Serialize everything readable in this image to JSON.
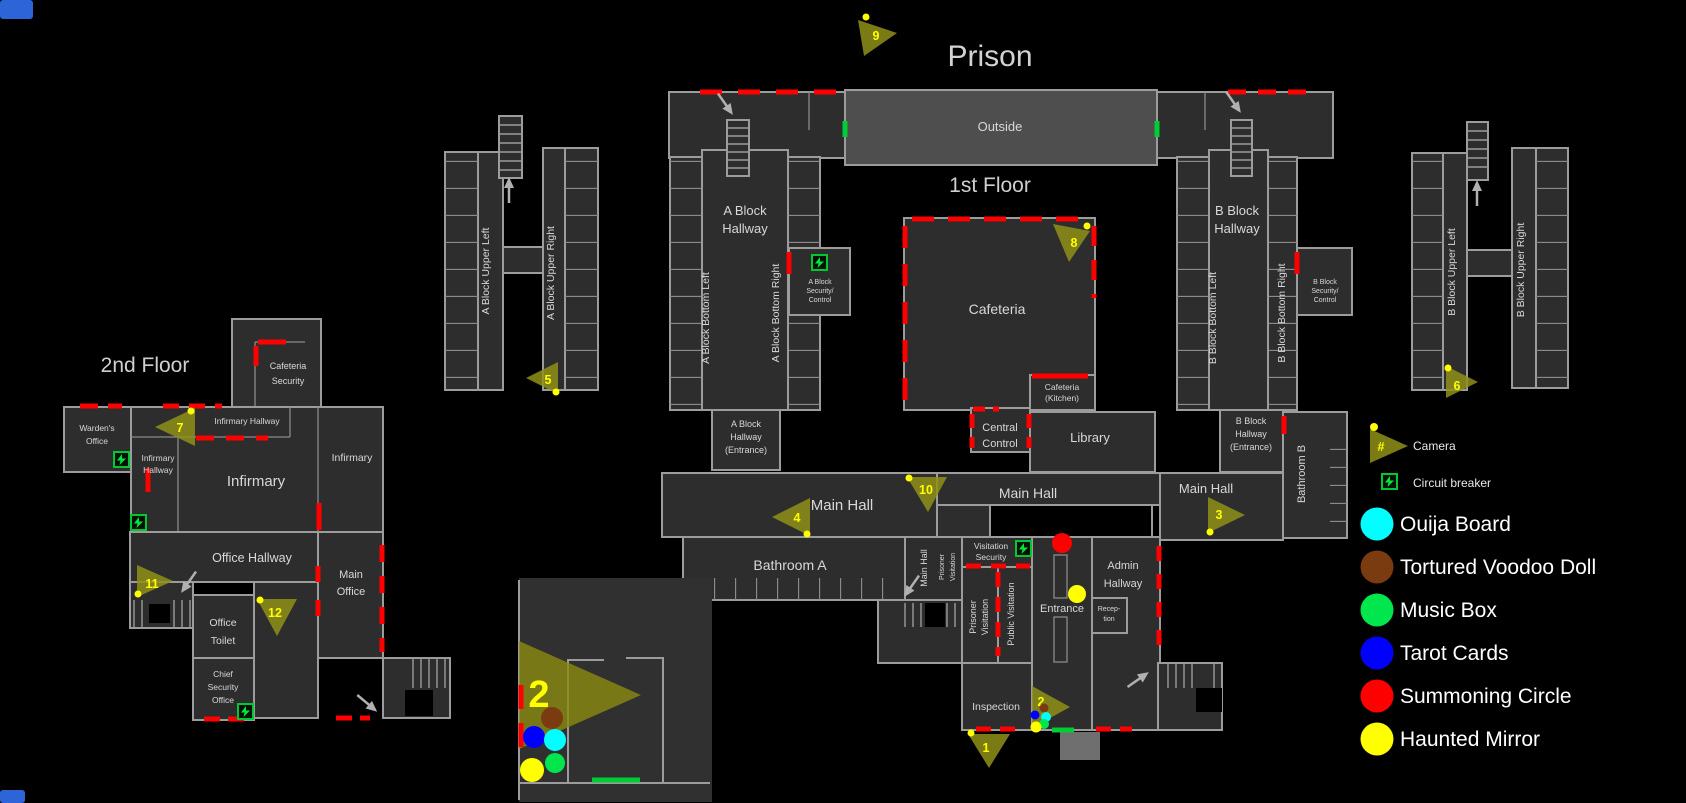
{
  "titles": {
    "prison": "Prison",
    "first_floor": "1st Floor",
    "second_floor": "2nd Floor"
  },
  "legend": {
    "camera_label": "Camera",
    "camera_symbol": "#",
    "breaker_label": "Circuit breaker",
    "items": [
      {
        "name": "Ouija Board",
        "color": "#00ffff"
      },
      {
        "name": "Tortured Voodoo Doll",
        "color": "#7a3b10"
      },
      {
        "name": "Music Box",
        "color": "#00e64c"
      },
      {
        "name": "Tarot Cards",
        "color": "#0000ff"
      },
      {
        "name": "Summoning Circle",
        "color": "#ff0000"
      },
      {
        "name": "Haunted Mirror",
        "color": "#ffff00"
      }
    ]
  },
  "camera_numbers": {
    "c1": "1",
    "c2": "2",
    "c3": "3",
    "c4": "4",
    "c5": "5",
    "c6": "6",
    "c7": "7",
    "c8": "8",
    "c9": "9",
    "c10": "10",
    "c11": "11",
    "c12": "12"
  },
  "rooms": {
    "outside": "Outside",
    "a_block_hallway": [
      "A Block",
      "Hallway"
    ],
    "a_block_bottom_left": "A Block Bottom Left",
    "a_block_bottom_right": "A Block Bottom Right",
    "a_block_security": [
      "A Block",
      "Security/",
      "Control"
    ],
    "a_block_entrance": [
      "A Block",
      "Hallway",
      "(Entrance)"
    ],
    "a_block_upper_left": "A Block Upper Left",
    "a_block_upper_right": "A Block Upper Right",
    "b_block_hallway": [
      "B Block",
      "Hallway"
    ],
    "b_block_bottom_left": "B Block Bottom Left",
    "b_block_bottom_right": "B Block Bottom Right",
    "b_block_security": [
      "B Block",
      "Security/",
      "Control"
    ],
    "b_block_entrance": [
      "B Block",
      "Hallway",
      "(Entrance)"
    ],
    "b_block_upper_left": "B Block Upper Left",
    "b_block_upper_right": "B Block Upper Right",
    "cafeteria": "Cafeteria",
    "kitchen": [
      "Cafeteria",
      "(Kitchen)"
    ],
    "central_control": [
      "Central",
      "Control"
    ],
    "library": "Library",
    "main_hall": "Main Hall",
    "bathroom_a": "Bathroom A",
    "bathroom_b": "Bathroom B",
    "visitation_security": [
      "Visitation",
      "Security"
    ],
    "prisoner_visitation": [
      "Prisoner",
      "Visitation"
    ],
    "public_visitation": "Public Visitation",
    "entrance": "Entrance",
    "reception": [
      "Recep-",
      "tion"
    ],
    "admin_hallway": [
      "Admin",
      "Hallway"
    ],
    "inspection": "Inspection",
    "wardens_office": [
      "Warden's",
      "Office"
    ],
    "cafeteria_security": [
      "Cafeteria",
      "Security"
    ],
    "infirmary_hallway_top": "Infirmary Hallway",
    "infirmary_hallway": [
      "Infirmary",
      "Hallway"
    ],
    "infirmary": "Infirmary",
    "office_hallway": "Office Hallway",
    "main_office": [
      "Main",
      "Office"
    ],
    "office_toilet": [
      "Office",
      "Toilet"
    ],
    "chief_security_office": [
      "Chief",
      "Security",
      "Office"
    ]
  }
}
